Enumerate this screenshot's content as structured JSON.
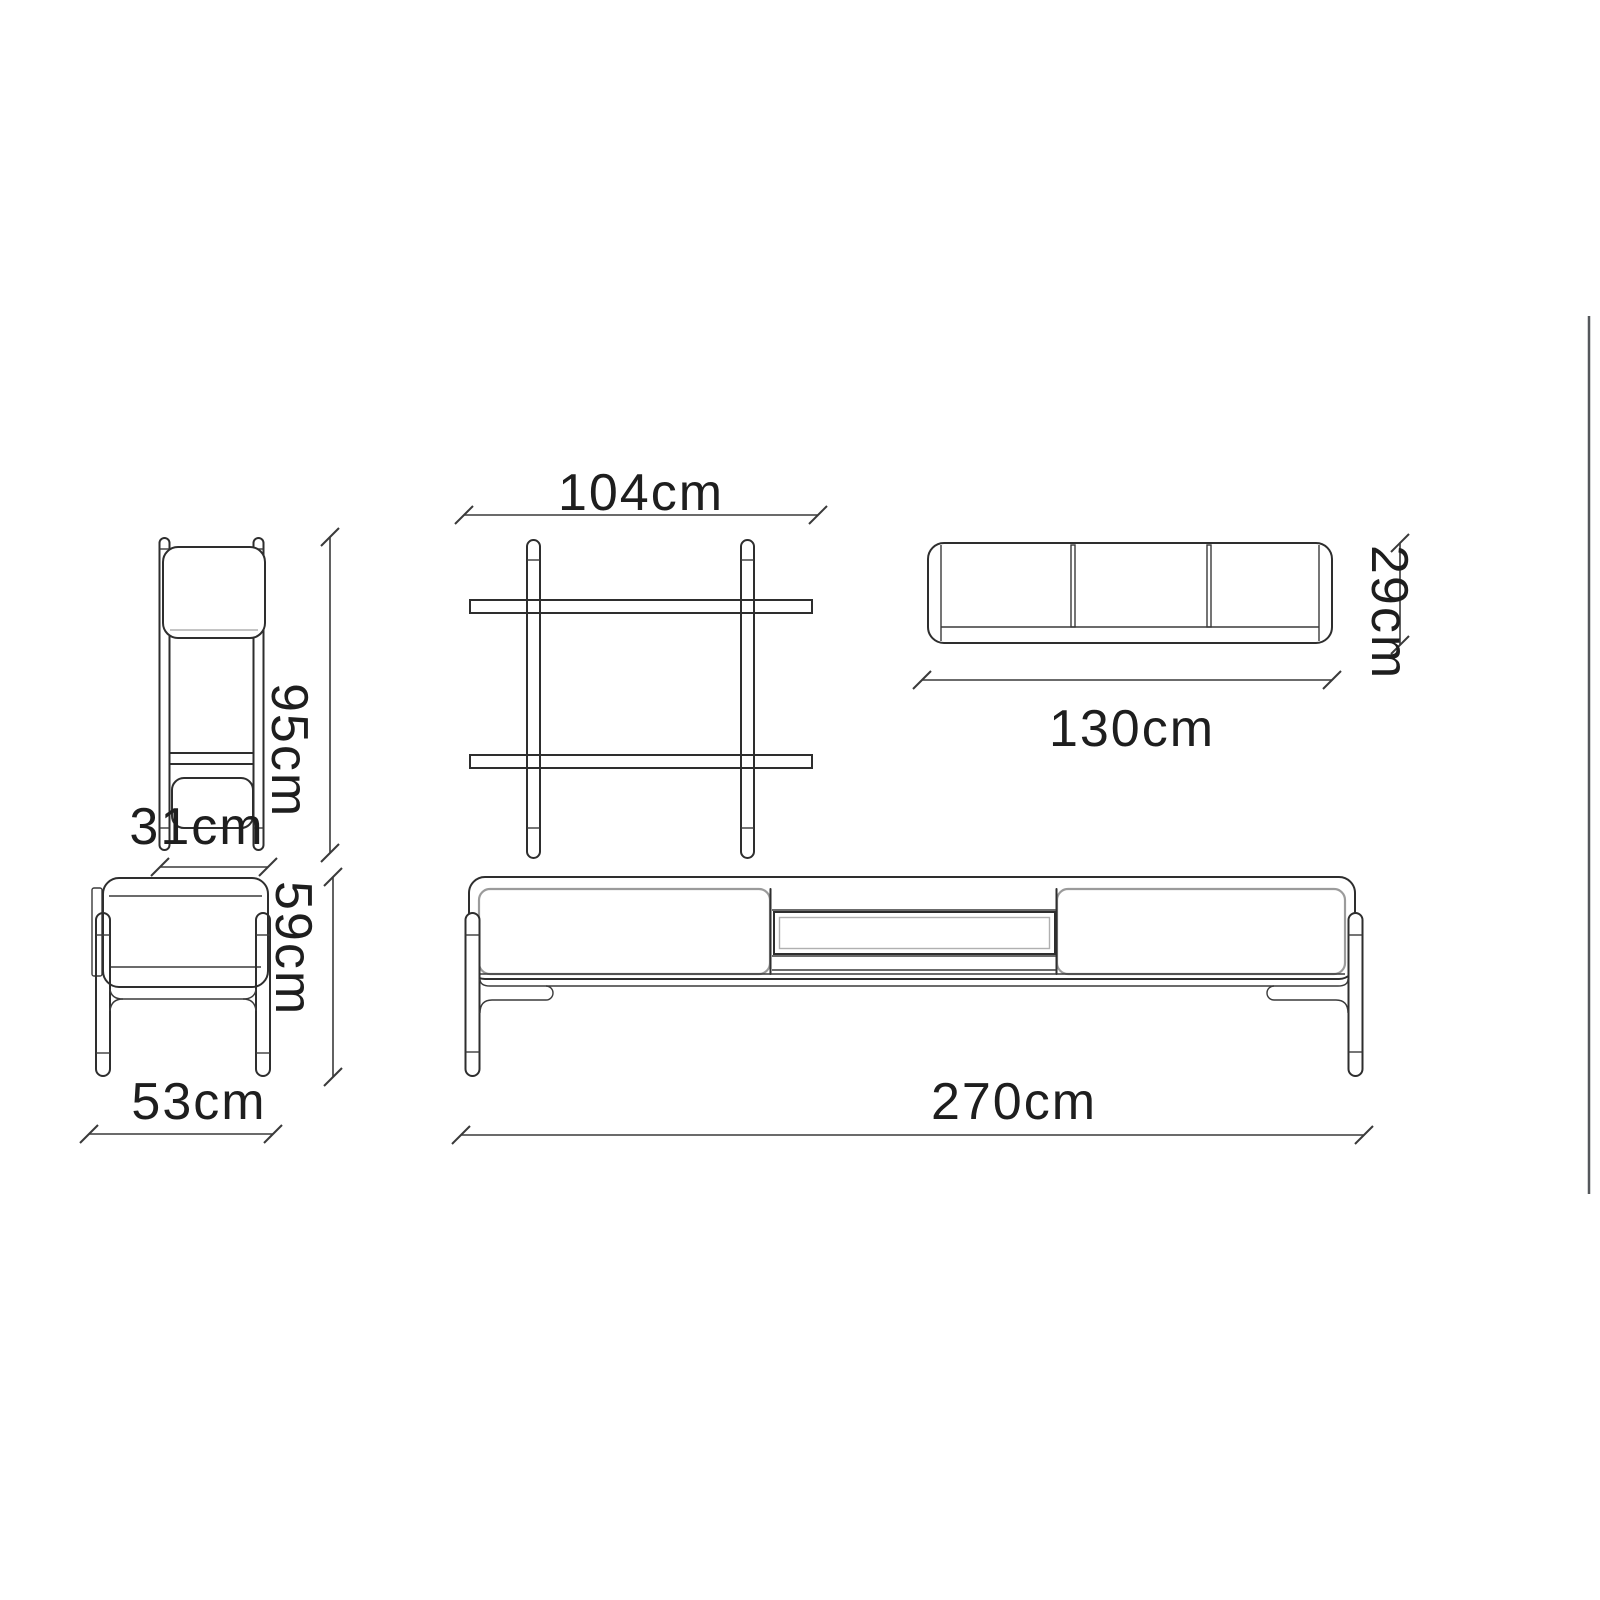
{
  "background": "#ffffff",
  "colors": {
    "outline": "#2e2e2e",
    "soft_line": "#9b9b9b",
    "dimension_line": "#3a3a3a",
    "label_text": "#1e1e1e",
    "scrollbar": "#55585c"
  },
  "dimensions": {
    "shelf_front_width": "104cm",
    "shelf_side_height": "95cm",
    "shelf_side_depth": "31cm",
    "wall_shelf_width": "130cm",
    "wall_shelf_height": "29cm",
    "tv_side_height": "59cm",
    "tv_side_depth": "53cm",
    "tv_front_width": "270cm"
  }
}
